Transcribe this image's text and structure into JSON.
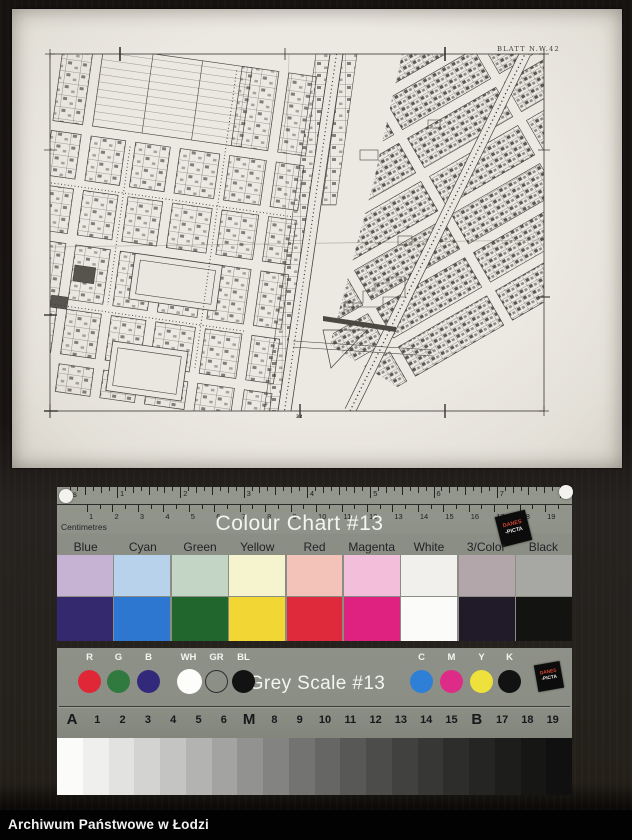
{
  "page": {
    "caption": "Archiwum Państwowe w Łodzi"
  },
  "photo": {
    "map_sheet_label": "BLATT N.W.42",
    "bottom_mark": "32"
  },
  "colour_chart": {
    "title": "Colour Chart #13",
    "brand_lines": [
      "DANES",
      "-PICTA"
    ],
    "ruler": {
      "inches_label": "ches",
      "cm_label": "Centimetres",
      "inch_numbers": [
        1,
        2,
        3,
        4,
        5,
        6,
        7
      ],
      "cm_numbers": [
        1,
        2,
        3,
        4,
        5,
        6,
        7,
        8,
        9,
        10,
        11,
        12,
        13,
        14,
        15,
        16,
        17,
        18,
        19
      ]
    },
    "columns": [
      {
        "label": "Blue",
        "pastel": "#c6b2d3",
        "solid": "#34286f"
      },
      {
        "label": "Cyan",
        "pastel": "#b9d2ec",
        "solid": "#2e77d0"
      },
      {
        "label": "Green",
        "pastel": "#c3d6c5",
        "solid": "#20662d"
      },
      {
        "label": "Yellow",
        "pastel": "#f6f4cf",
        "solid": "#f2d634"
      },
      {
        "label": "Red",
        "pastel": "#f3c2b8",
        "solid": "#df2a3c"
      },
      {
        "label": "Magenta",
        "pastel": "#f2bed9",
        "solid": "#df2180"
      },
      {
        "label": "White",
        "pastel": "#f2f0ec",
        "solid": "#fbfbfa"
      },
      {
        "label": "3/Color",
        "pastel": "#b2a6ab",
        "solid": "#201a29"
      },
      {
        "label": "Black",
        "pastel": "#a7a7a4",
        "solid": "#131312"
      }
    ]
  },
  "grey_scale": {
    "title": "Grey Scale #13",
    "brand_lines": [
      "DANES",
      "-PICTA"
    ],
    "left_dots": [
      {
        "label": "R",
        "color": "#e02737",
        "hollow": false
      },
      {
        "label": "G",
        "color": "#30793f",
        "hollow": false
      },
      {
        "label": "B",
        "color": "#33297b",
        "hollow": false
      },
      {
        "label": "WH",
        "color": "#fdfdfb",
        "hollow": false
      },
      {
        "label": "GR",
        "color": "",
        "hollow": true
      },
      {
        "label": "BL",
        "color": "#121212",
        "hollow": false
      }
    ],
    "right_dots": [
      {
        "label": "C",
        "color": "#2e7fd6",
        "hollow": false
      },
      {
        "label": "M",
        "color": "#df2b88",
        "hollow": false
      },
      {
        "label": "Y",
        "color": "#efe13c",
        "hollow": false
      },
      {
        "label": "K",
        "color": "#121212",
        "hollow": false
      }
    ],
    "index_row": [
      "A",
      "1",
      "2",
      "3",
      "4",
      "5",
      "6",
      "M",
      "8",
      "9",
      "10",
      "11",
      "12",
      "13",
      "14",
      "15",
      "B",
      "17",
      "18",
      "19"
    ],
    "steps": [
      "#fbfbf9",
      "#efefed",
      "#e2e2e0",
      "#d3d3d1",
      "#c4c4c2",
      "#b3b3b1",
      "#a3a3a1",
      "#929290",
      "#838381",
      "#737371",
      "#666664",
      "#585856",
      "#4c4c4a",
      "#41413f",
      "#373735",
      "#2d2d2b",
      "#252523",
      "#1d1d1b",
      "#161614",
      "#101010"
    ]
  }
}
